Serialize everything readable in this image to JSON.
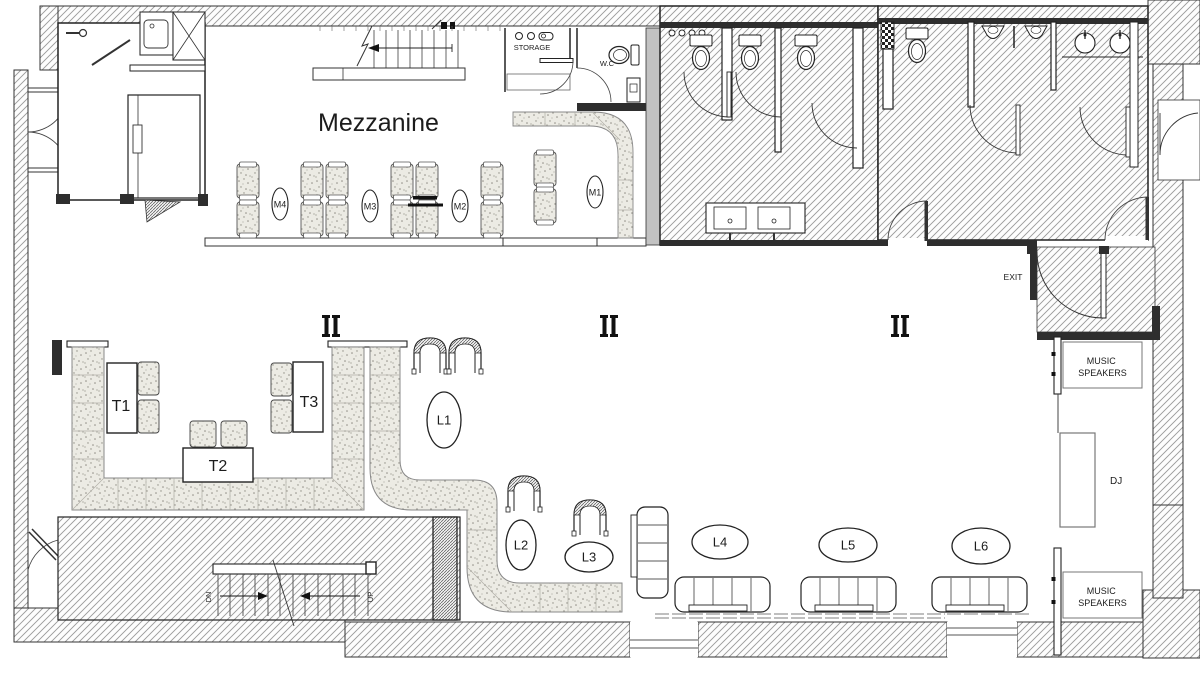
{
  "title": "Mezzanine",
  "labels": {
    "storage": "STORAGE",
    "wc": "W.C",
    "exit": "EXIT",
    "dj": "DJ",
    "music": "MUSIC",
    "speakers": "SPEAKERS",
    "up": "UP",
    "down": "DN"
  },
  "mezzanine_tables": [
    "M1",
    "M2",
    "M3",
    "M4"
  ],
  "tables": [
    "T1",
    "T2",
    "T3"
  ],
  "lounges": [
    "L1",
    "L2",
    "L3",
    "L4",
    "L5",
    "L6"
  ],
  "colors": {
    "ink": "#222222",
    "wall_dark": "#2e2e2e",
    "hatch_line": "#9a9a9a",
    "tile_bg": "#ecebe4",
    "tile_dot": "#8f8d85"
  }
}
